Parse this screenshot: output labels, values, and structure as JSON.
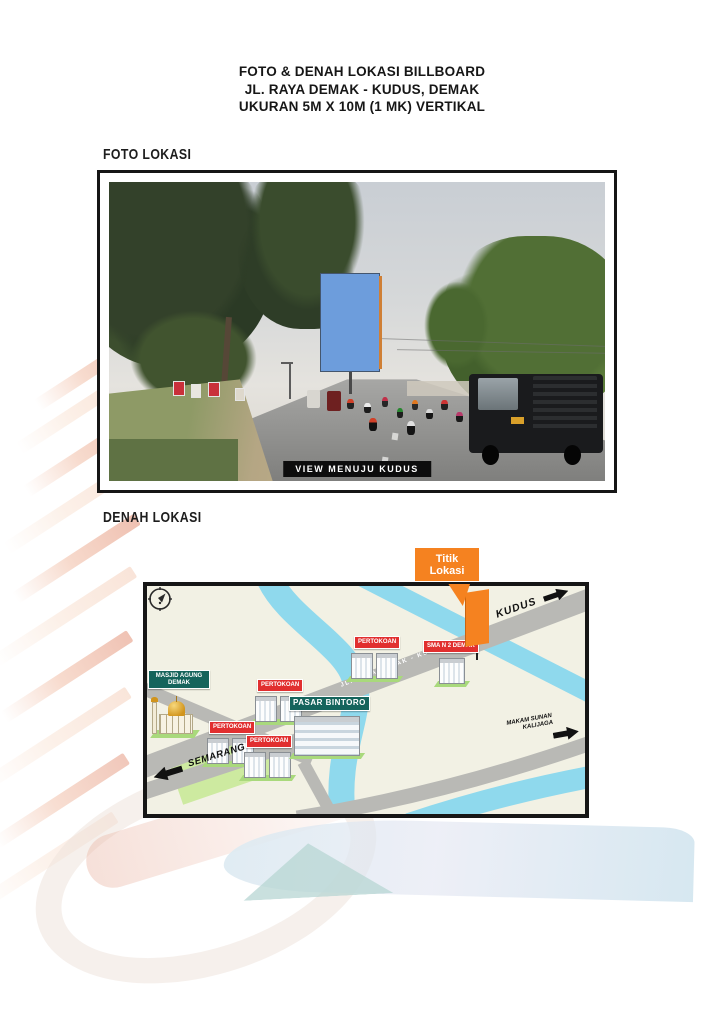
{
  "document": {
    "title_lines": [
      "FOTO & DENAH LOKASI BILLBOARD",
      "JL. RAYA DEMAK - KUDUS, DEMAK",
      "UKURAN 5M X 10M (1 MK) VERTIKAL"
    ],
    "photo_section": {
      "heading": "FOTO LOKASI",
      "caption": "VIEW MENUJU KUDUS"
    },
    "map_section": {
      "heading": "DENAH LOKASI",
      "callout_lines": [
        "Titik",
        "Lokasi"
      ],
      "road_label": "JL. RAYA DEMAK - KUDUS",
      "directions": {
        "kudus": "KUDUS",
        "semarang": "SEMARANG",
        "makam_lines": [
          "MAKAM SUNAN",
          "KALIJAGA"
        ]
      },
      "labels": {
        "pertokoan": "PERTOKOAN",
        "sma": "SMA N 2 DEMAK",
        "masjid_lines": [
          "MASJID AGUNG",
          "DEMAK"
        ],
        "pasar": "PASAR BINTORO"
      }
    },
    "colors": {
      "accent_orange": "#f58220",
      "label_red": "#e12f2f",
      "label_teal": "#15645c",
      "river_blue": "#8fd9ed",
      "road_gray": "#b9b9b5",
      "field_green": "#cdeaa0",
      "billboard_blue": "#6d9ddc"
    }
  }
}
